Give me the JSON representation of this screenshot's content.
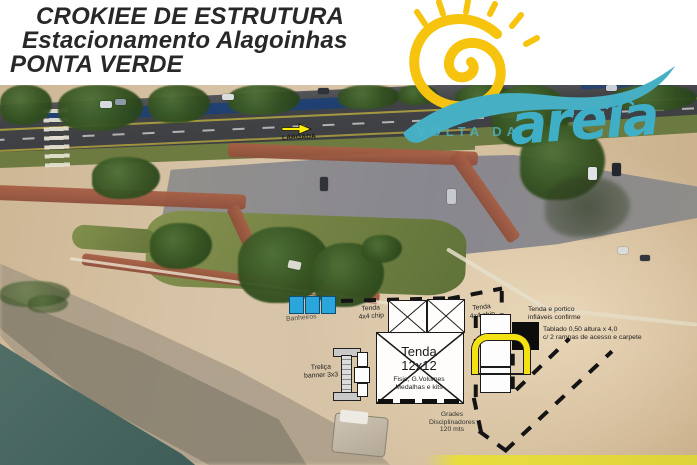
{
  "header": {
    "title_lines": [
      "CROKIEE DE ESTRUTURA",
      "Estacionamento Alagoinhas",
      "PONTA VERDE"
    ]
  },
  "logo": {
    "tagline": "VOLTA DA",
    "script": "areia",
    "colors": {
      "sun": "#F6C40E",
      "wave": "#47AFC4",
      "script": "#3FAFC8"
    }
  },
  "annotations": {
    "largada": "LARGADA",
    "banheiros": "Banheiros",
    "trelica": "Treliça\nbanner 3x3",
    "tenda4_left": "Tenda\n4x4 chip",
    "tenda4_right": "Tenda\n4x4 chip",
    "tenda12_title": "Tenda\n12x12",
    "tenda12_sub": "Fisio, G.Volumes\nMedalhas e kits",
    "portico": "Tenda e portico\ninfláveis confirme",
    "tablado": "Tablado 0,50 altura x 4,0\nc/ 2 rampas de acesso e carpete",
    "grades": "Grades\nDisciplinadores\n120 mts"
  },
  "colors": {
    "banheiro_blue": "#2BA6DC",
    "portico_yellow": "#F3E111",
    "largada_yellow": "#FFEE00",
    "dash_black": "#141414",
    "bottom_band_yellow": "#E8DD3F"
  }
}
